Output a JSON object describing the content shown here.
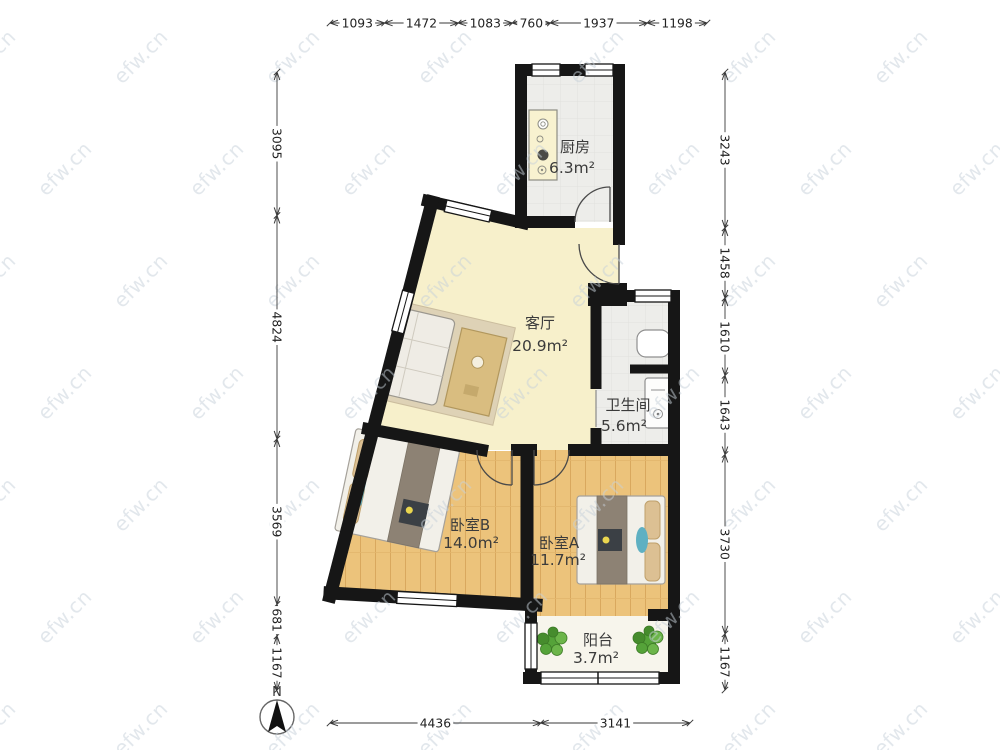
{
  "watermark": {
    "text": "efw.cn"
  },
  "north": {
    "label": "N"
  },
  "rooms": {
    "kitchen": {
      "name": "厨房",
      "area": "6.3m²"
    },
    "living": {
      "name": "客厅",
      "area": "20.9m²"
    },
    "bathroom": {
      "name": "卫生间",
      "area": "5.6m²"
    },
    "bedroomB": {
      "name": "卧室B",
      "area": "14.0m²"
    },
    "bedroomA": {
      "name": "卧室A",
      "area": "11.7m²"
    },
    "balcony": {
      "name": "阳台",
      "area": "3.7m²"
    }
  },
  "dimensions": {
    "top": {
      "values": [
        1093,
        1472,
        1083,
        760,
        1937,
        1198
      ]
    },
    "bottom": {
      "values": [
        4436,
        3141
      ]
    },
    "left": {
      "values": [
        3095,
        4824,
        3569,
        681,
        1167
      ]
    },
    "right": {
      "values": [
        3243,
        1458,
        1610,
        1643,
        3730,
        1167
      ]
    }
  },
  "colors": {
    "wall": "#161616",
    "living_floor": "#f7f0cb",
    "wood_floor": "#ecc37b",
    "tile_floor": "#ededea",
    "balcony_floor": "#f7f5ec",
    "dim_text": "#222222",
    "watermark": "#c7d1da",
    "plant_green": "#55a339",
    "accent_teal": "#5fb0c2"
  }
}
